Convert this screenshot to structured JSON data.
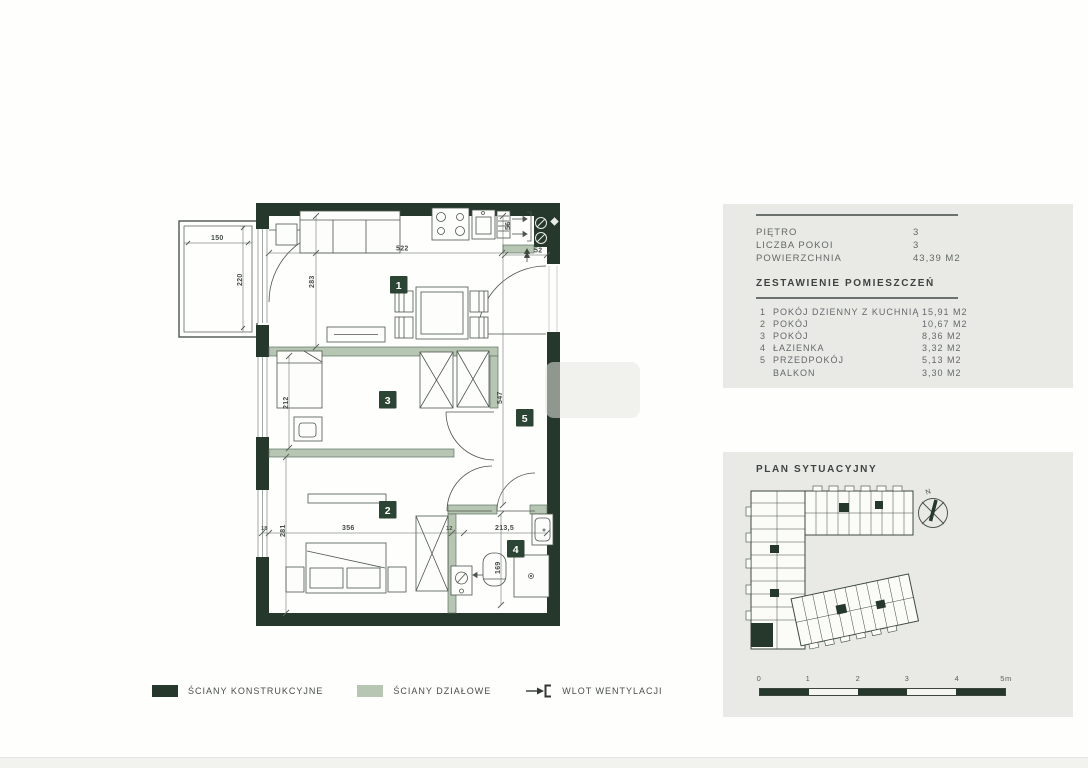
{
  "info_panel": {
    "rows": [
      {
        "label": "PIĘTRO",
        "value": "3"
      },
      {
        "label": "LICZBA POKOI",
        "value": "3"
      },
      {
        "label": "POWIERZCHNIA",
        "value": "43,39 M2"
      }
    ],
    "rooms_heading": "ZESTAWIENIE POMIESZCZEŃ",
    "rooms": [
      {
        "no": "1",
        "name": "POKÓJ DZIENNY Z KUCHNIĄ",
        "area": "15,91 M2"
      },
      {
        "no": "2",
        "name": "POKÓJ",
        "area": "10,67 M2"
      },
      {
        "no": "3",
        "name": "POKÓJ",
        "area": "8,36 M2"
      },
      {
        "no": "4",
        "name": "ŁAZIENKA",
        "area": "3,32 M2"
      },
      {
        "no": "5",
        "name": "PRZEDPOKÓJ",
        "area": "5,13 M2"
      },
      {
        "no": "",
        "name": "BALKON",
        "area": "3,30 M2"
      }
    ]
  },
  "site_panel": {
    "title": "PLAN SYTUACYJNY",
    "compass": "N",
    "scale_ticks": [
      "0",
      "1",
      "2",
      "3",
      "4",
      "5m"
    ]
  },
  "legend": {
    "items": [
      {
        "label": "ŚCIANY KONSTRUKCYJNE",
        "swatch": "structural-dark"
      },
      {
        "label": "ŚCIANY DZIAŁOWE",
        "swatch": "partition-light"
      },
      {
        "label": "WLOT WENTYLACJI",
        "swatch": "vent-arrow-icon"
      }
    ]
  },
  "plan": {
    "badges": {
      "b1": "1",
      "b2": "2",
      "b3": "3",
      "b4": "4",
      "b5": "5"
    },
    "dims": {
      "d150": "150",
      "d220": "220",
      "d283": "283",
      "d522": "522",
      "d56": "56",
      "d52": "52",
      "d212": "212",
      "d547": "547",
      "d281": "281",
      "d356": "356",
      "d18": "18",
      "d12": "12",
      "d2135": "213,5",
      "d169": "169"
    }
  },
  "colors": {
    "wall": "#26382c",
    "partition": "#b7c6b2",
    "panel_bg": "#e9eae5",
    "badge": "#2c4434"
  }
}
